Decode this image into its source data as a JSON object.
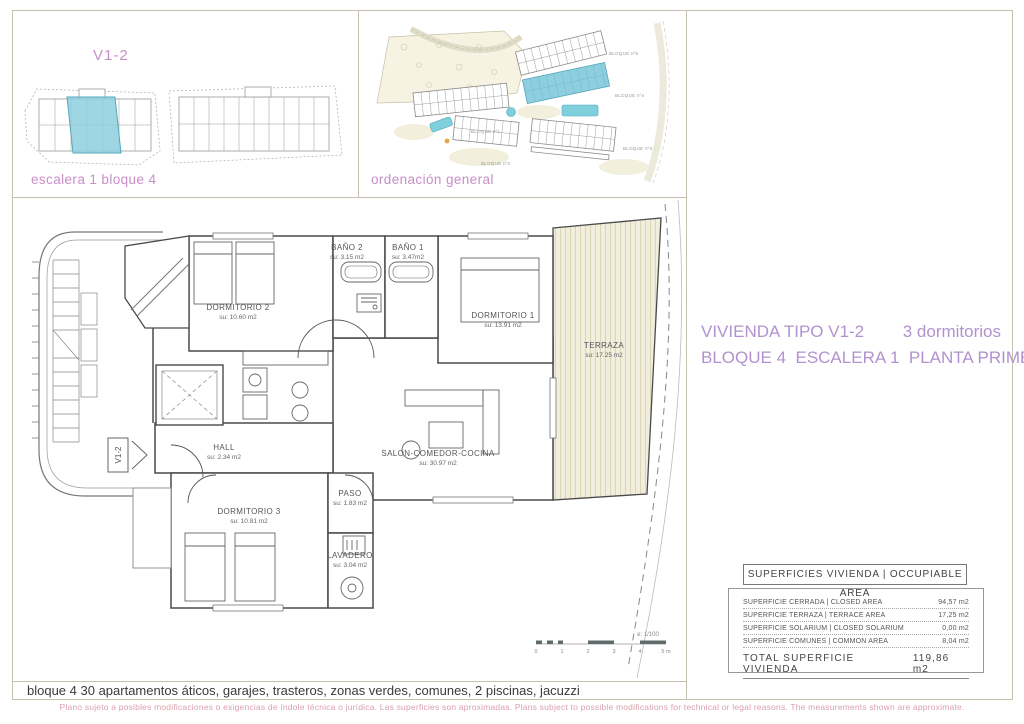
{
  "page": {
    "bottom_note": "bloque 4 30 apartamentos áticos, garajes, trasteros, zonas verdes, comunes, 2 piscinas, jacuzzi",
    "footer_disclaimer": "Plano sujeto a posibles modificaciones o exigencias de índole técnica o jurídica. Las superficies son aproximadas. Plans subject to possible modifications for technical or legal reasons. The measurements shown are approximate."
  },
  "colors": {
    "accent_pink": "#c78fc7",
    "title_purple": "#b292ce",
    "footer_pink": "#d9a0ae",
    "frame_line": "#c6c0ae",
    "highlight_teal": "#8ecfdf",
    "terrace_fill": "#f2eedd",
    "plan_line": "#4a4a4a"
  },
  "panels": {
    "unit_locator": {
      "label": "V1-2",
      "caption": "escalera 1 bloque 4"
    },
    "site_plan": {
      "caption": "ordenación general",
      "block_labels": [
        "BLOQUE nº5",
        "BLOQUE nº4",
        "BLOQUE nº3",
        "BLOQUE nº2",
        "BLOQUE nº1"
      ]
    }
  },
  "title": {
    "line1_left": "VIVIENDA TIPO V1-2",
    "line1_right": "3 dormitorios",
    "line2": "BLOQUE 4  ESCALERA 1  PLANTA PRIMERA"
  },
  "floor_plan": {
    "unit_marker": "V1-2",
    "rooms": [
      {
        "name": "DORMITORIO 2",
        "area": "su: 10.60 m2",
        "x": 225,
        "y": 112
      },
      {
        "name": "BAÑO 2",
        "area": "su: 3.15 m2",
        "x": 334,
        "y": 52
      },
      {
        "name": "BAÑO 1",
        "area": "su: 3.47m2",
        "x": 395,
        "y": 52
      },
      {
        "name": "DORMITORIO 1",
        "area": "su: 13.91 m2",
        "x": 490,
        "y": 120
      },
      {
        "name": "TERRAZA",
        "area": "su: 17.25 m2",
        "x": 591,
        "y": 150
      },
      {
        "name": "HALL",
        "area": "su: 2.34 m2",
        "x": 211,
        "y": 252
      },
      {
        "name": "SALON-COMEDOR-COCINA",
        "area": "su: 30.97 m2",
        "x": 425,
        "y": 258
      },
      {
        "name": "PASO",
        "area": "su: 1.83 m2",
        "x": 337,
        "y": 298
      },
      {
        "name": "DORMITORIO 3",
        "area": "su: 10.81 m2",
        "x": 236,
        "y": 316
      },
      {
        "name": "LAVADERO",
        "area": "su: 3.04 m2",
        "x": 337,
        "y": 360
      }
    ],
    "scale": {
      "label": "e: 1/100",
      "ticks": [
        "0",
        "1",
        "2",
        "3",
        "4",
        "5 m"
      ]
    }
  },
  "area_table": {
    "header": "SUPERFICIES VIVIENDA | OCCUPIABLE AREA",
    "rows": [
      {
        "label": "SUPERFICIE CERRADA | CLOSED AREA",
        "value": "94,57 m2"
      },
      {
        "label": "SUPERFICIE TERRAZA | TERRACE AREA",
        "value": "17,25 m2"
      },
      {
        "label": "SUPERFICIE SOLARIUM | CLOSED SOLARIUM",
        "value": "0,00 m2"
      },
      {
        "label": "SUPERFICIE COMUNES | COMMON AREA",
        "value": "8,04 m2"
      }
    ],
    "total": {
      "label": "TOTAL SUPERFICIE VIVIENDA",
      "value": "119,86 m2"
    }
  }
}
